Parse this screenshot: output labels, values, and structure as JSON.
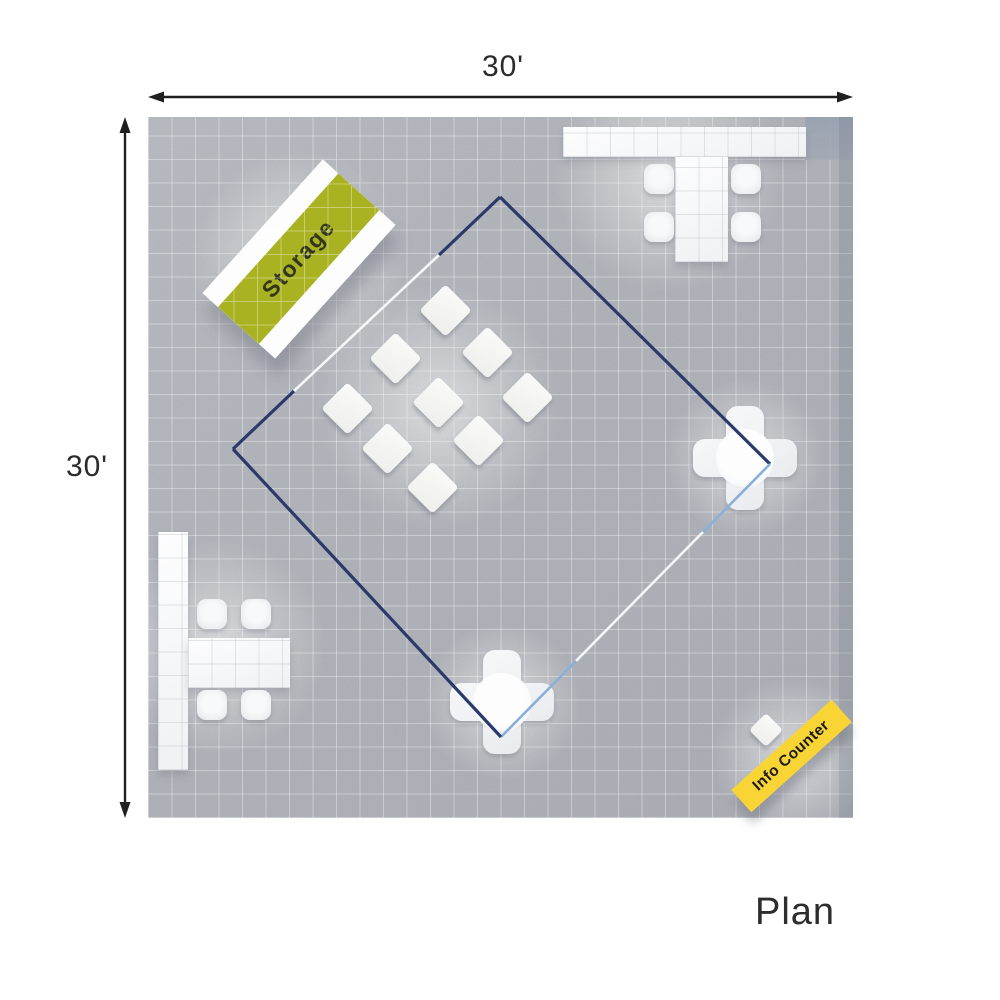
{
  "caption": "Plan",
  "dimensions": {
    "width": "30'",
    "height": "30'"
  },
  "zones": {
    "storage_label": "Storage",
    "info_counter_label": "Info Counter"
  },
  "furniture_summary": {
    "display_diamond_count": 9,
    "cross_seating_count": 2,
    "conference_tables": 2
  },
  "colors": {
    "floor": "#b2b5ba",
    "storage_green": "#a9b321",
    "info_yellow": "#f8d535",
    "outline_navy": "#2c3a6b",
    "outline_lightblue": "#8ab0d8",
    "dimension": "#1f1f1f"
  }
}
